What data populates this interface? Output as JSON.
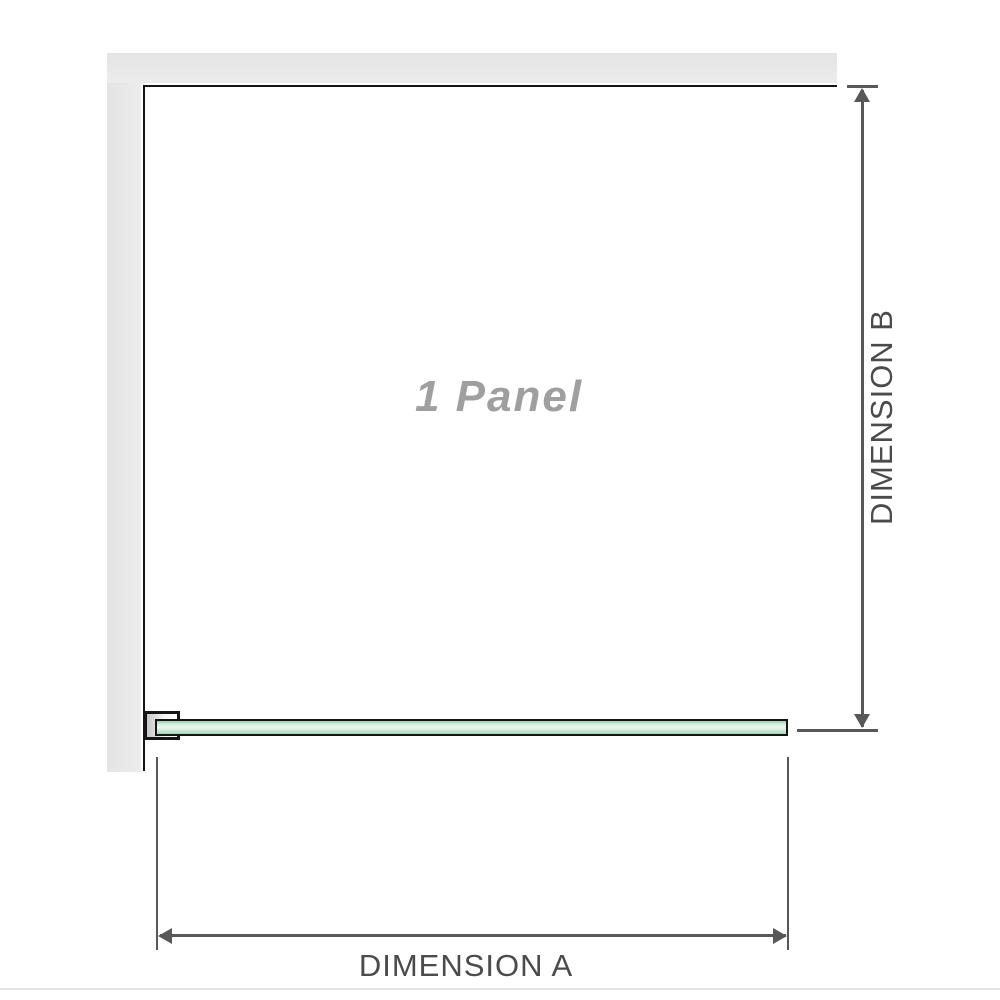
{
  "diagram": {
    "panel_label": "1 Panel",
    "dimension_a": {
      "label": "DIMENSION A"
    },
    "dimension_b": {
      "label": "DIMENSION B"
    }
  },
  "colors": {
    "wall_fill": "#ececec",
    "wall_fill_edge": "#e4e4e4",
    "outline": "#151515",
    "dimension_line": "#58585a",
    "dimension_text": "#4b4b4d",
    "panel_text": "#9f9f9f",
    "glass_green_dark": "#9fcbae",
    "glass_green_light": "#eaf8ee",
    "glass_green_mid": "#aad4b8",
    "bracket_gray": "#c7c7c7",
    "divider": "#e3e3e1"
  }
}
